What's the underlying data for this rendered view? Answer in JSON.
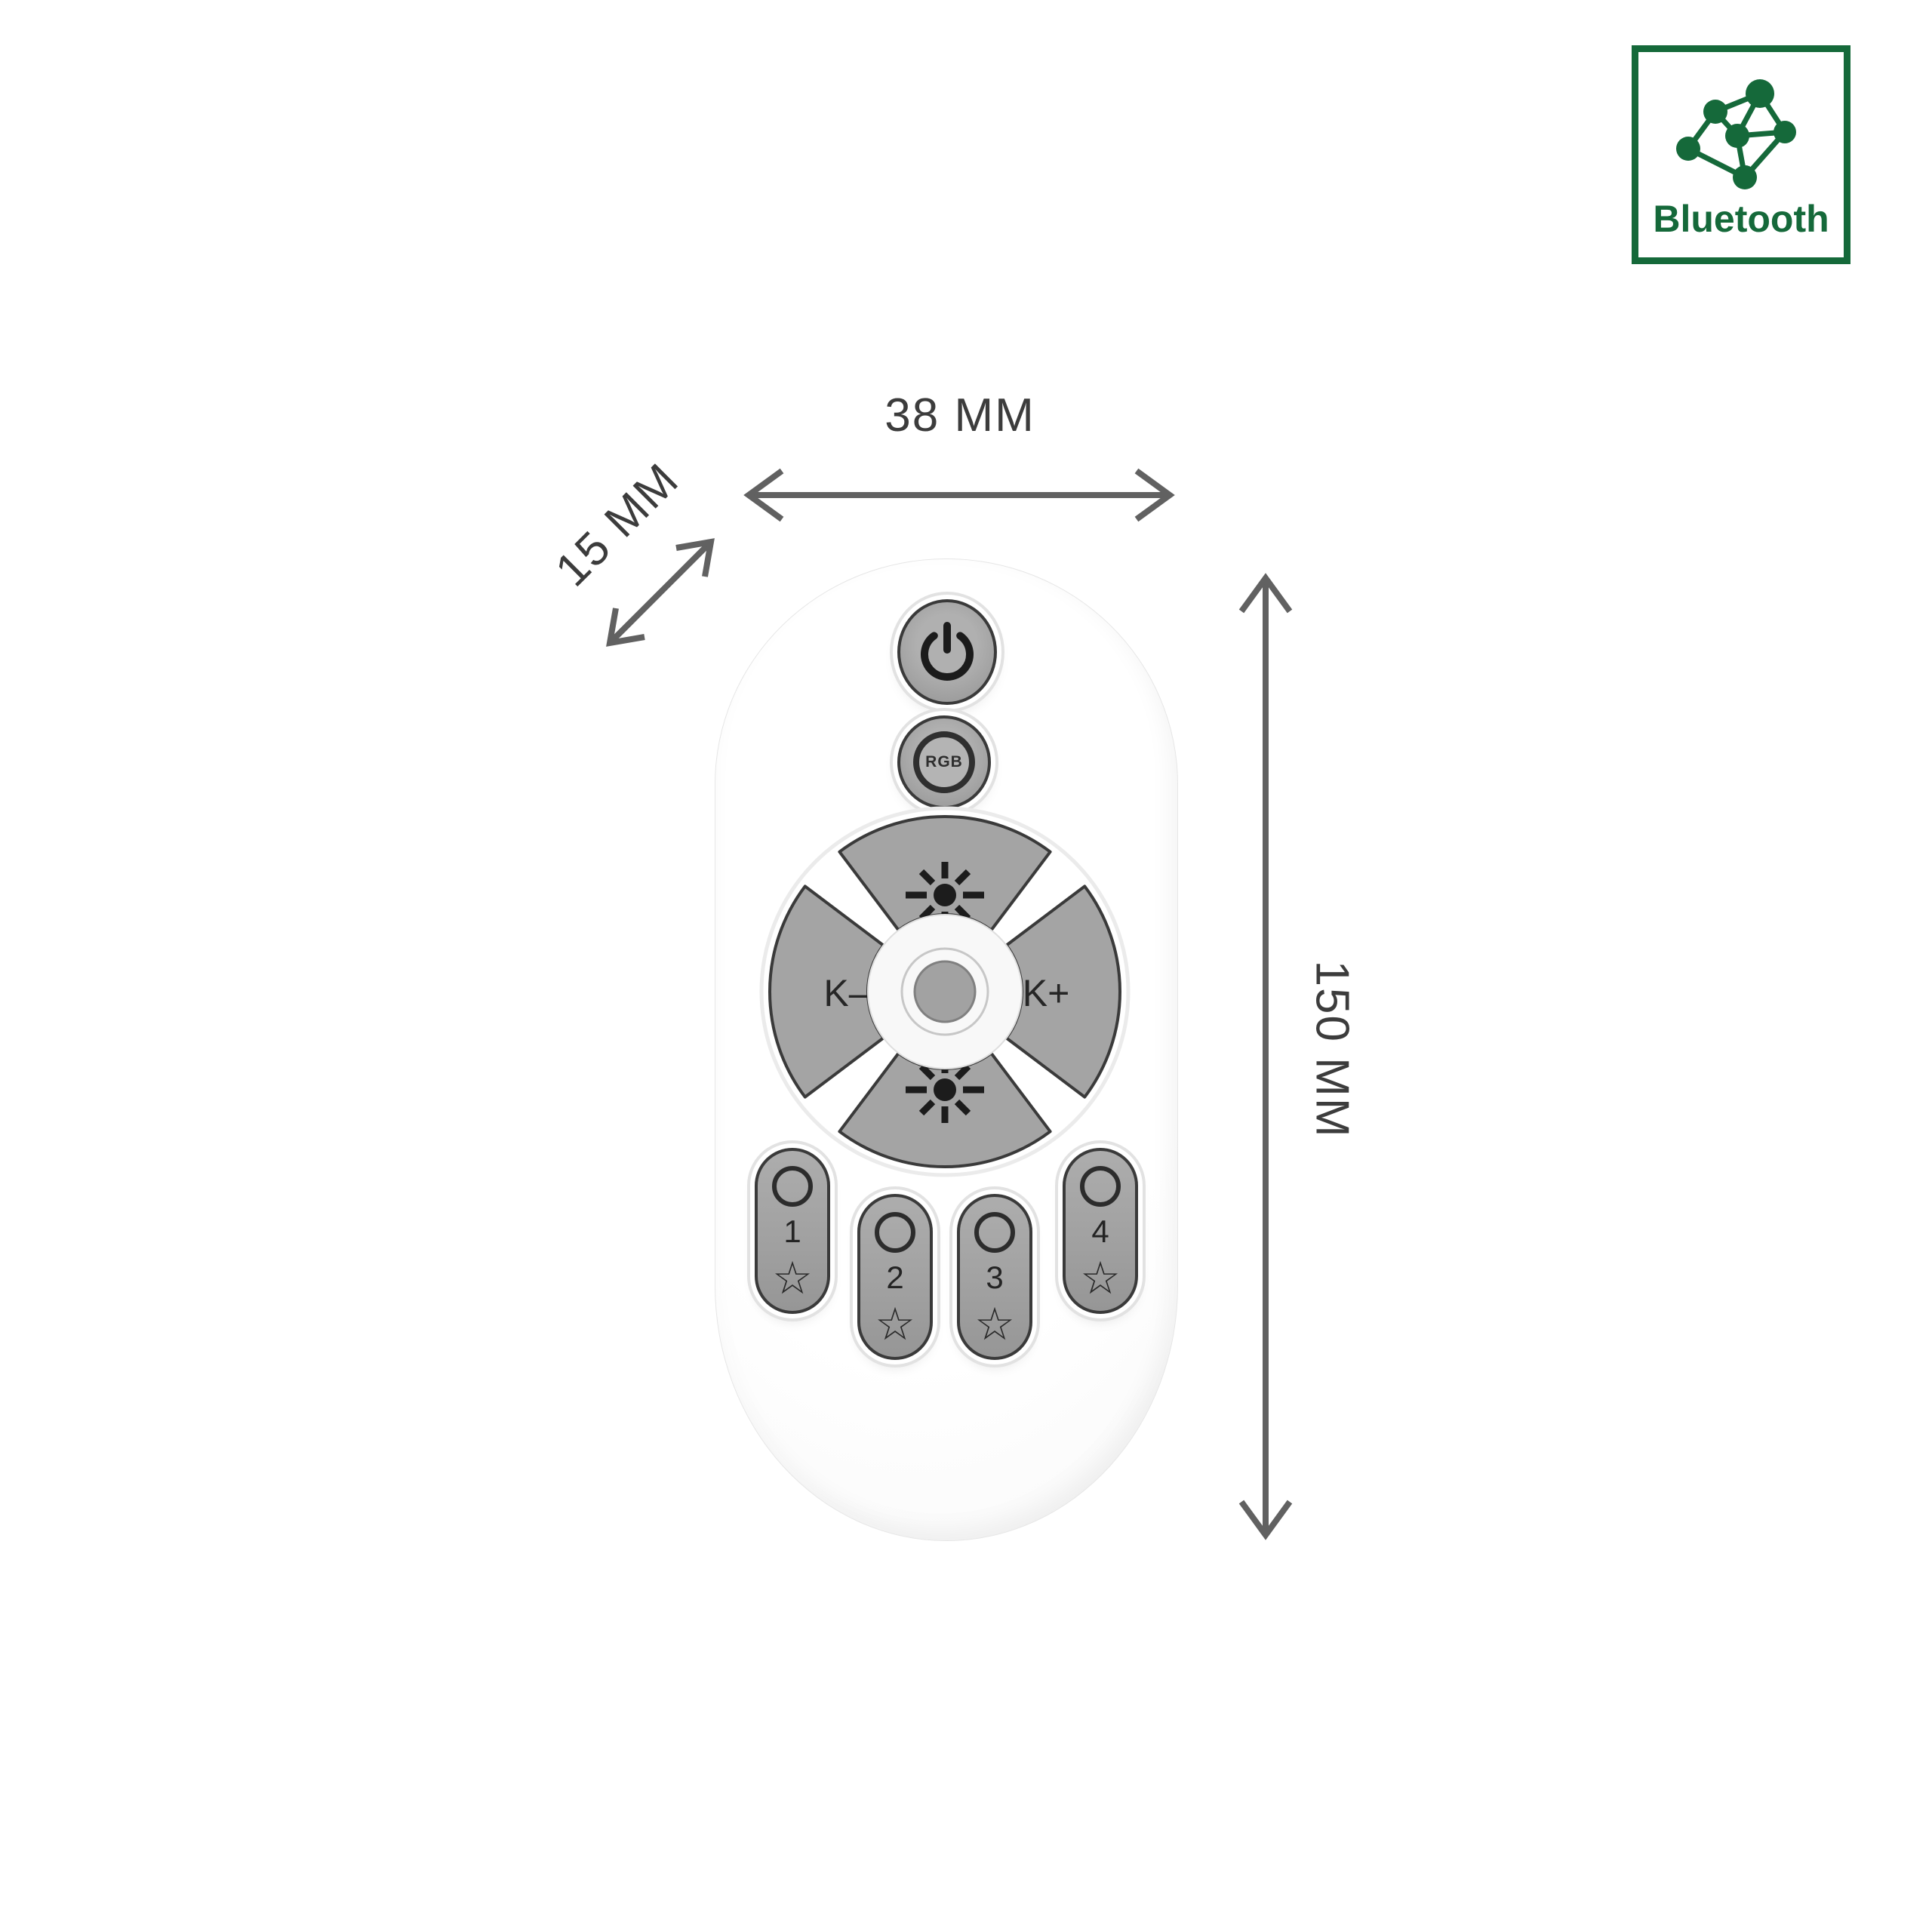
{
  "colors": {
    "accent_green": "#15693a",
    "button_gray": "#a4a4a4",
    "outline_dark": "#3a3a3a",
    "dimension_gray": "#616161",
    "body_white": "#ffffff"
  },
  "bluetooth_badge": {
    "label": "Bluetooth",
    "icon": "mesh-network-icon"
  },
  "dimensions": {
    "width_label": "38 MM",
    "depth_label": "15 MM",
    "height_label": "150 MM"
  },
  "remote": {
    "power_icon": "power-icon",
    "rgb_label": "RGB",
    "dpad": {
      "up_icon": "brightness-up-icon",
      "down_icon": "brightness-down-icon",
      "left_label": "K–",
      "right_label": "K+"
    },
    "channel_buttons": [
      {
        "number": "1",
        "star": "☆"
      },
      {
        "number": "2",
        "star": "☆"
      },
      {
        "number": "3",
        "star": "☆"
      },
      {
        "number": "4",
        "star": "☆"
      }
    ]
  }
}
